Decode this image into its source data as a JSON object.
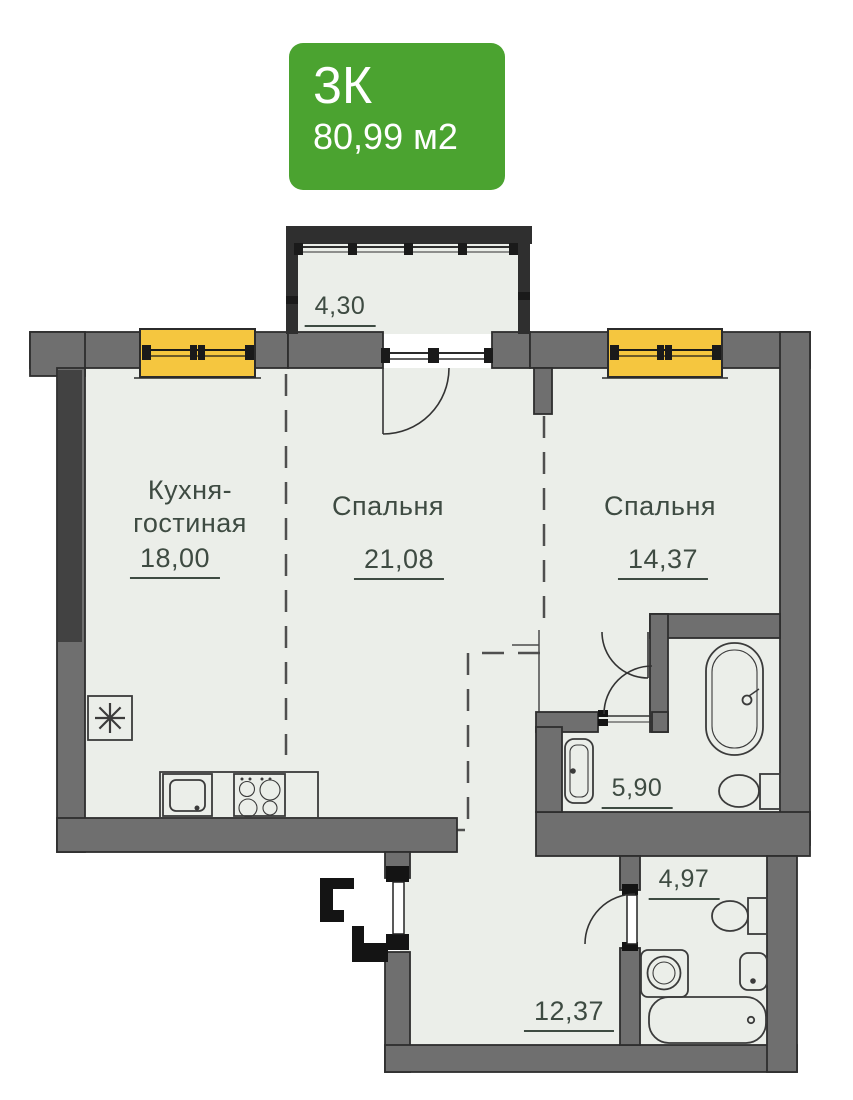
{
  "badge": {
    "rooms": "3К",
    "area": "80,99 м2"
  },
  "rooms": {
    "balcony": {
      "area": "4,30"
    },
    "kitchen_living": {
      "name_line1": "Кухня-",
      "name_line2": "гостиная",
      "area": "18,00"
    },
    "bedroom1": {
      "name": "Спальня",
      "area": "21,08"
    },
    "bedroom2": {
      "name": "Спальня",
      "area": "14,37"
    },
    "bathroom1": {
      "area": "5,90"
    },
    "bathroom2": {
      "area": "4,97"
    },
    "hallway": {
      "area": "12,37"
    }
  },
  "colors": {
    "badge_green": "#4BA330",
    "wall_gray": "#6F6F6F",
    "wall_dark": "#2D2D2D",
    "window_yellow": "#F5C63F",
    "floor": "#EBEEE9",
    "label_text": "#3E4B42"
  },
  "fixtures": [
    "balcony-glazing",
    "window",
    "entrance-door",
    "ventilation-shaft",
    "kitchen-sink",
    "stove",
    "bathtub",
    "toilet",
    "bathroom-sink",
    "washing-machine"
  ]
}
